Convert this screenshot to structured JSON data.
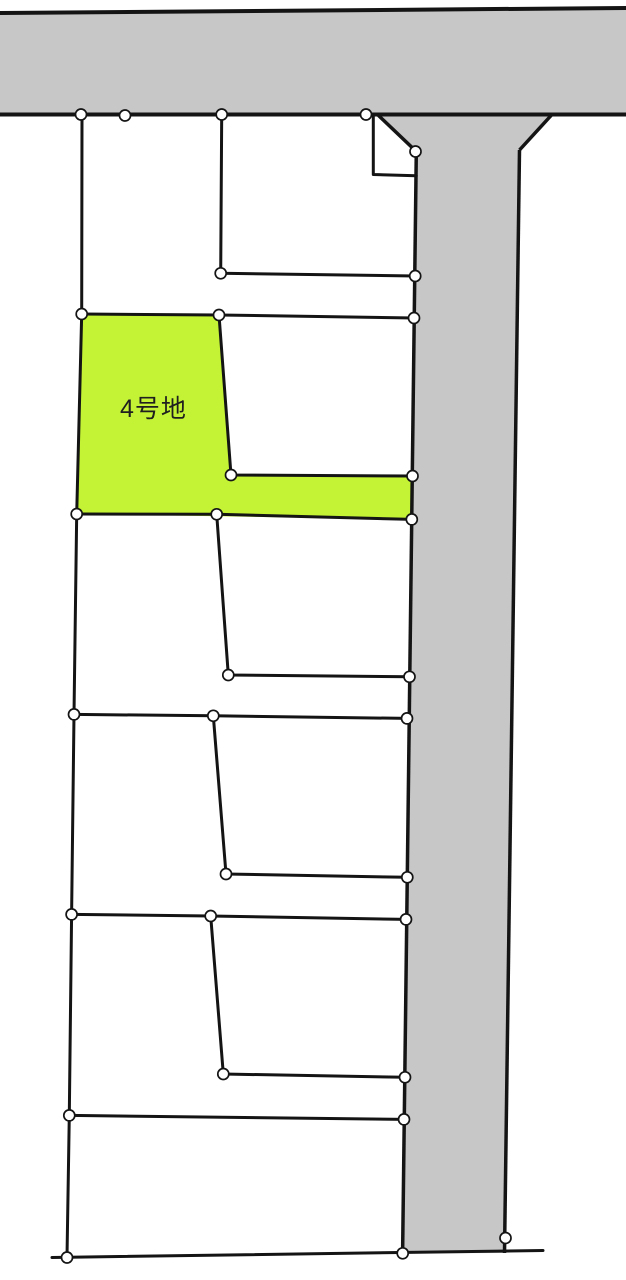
{
  "map": {
    "highlighted_lot_label": "4号地",
    "colors": {
      "road_fill": "#c7c7c7",
      "lot_highlight_fill": "#c3f334",
      "boundary_line": "#141414",
      "label_text": "#1f1f1f",
      "marker_fill": "#ffffff",
      "background": "#ffffff"
    }
  }
}
